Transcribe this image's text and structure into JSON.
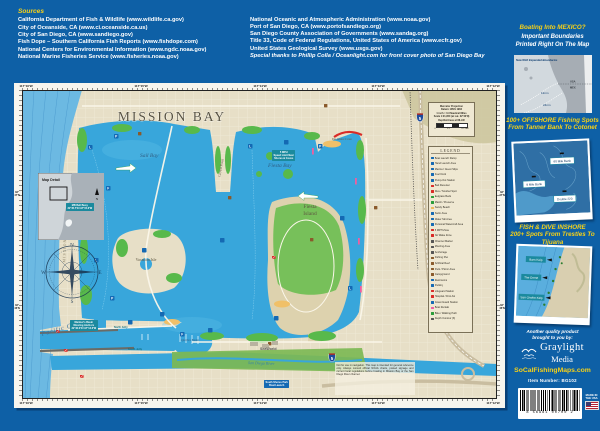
{
  "colors": {
    "background": "#0e60a6",
    "accent_yellow": "#f7d117",
    "ocean": "#6cb9e2",
    "bay": "#38a6db",
    "land": "#e7dfc7",
    "eelgrass": "#58b94b",
    "legend_paper": "#efe8d2",
    "callout_teal": "#1b8a9e",
    "marker_blue": "#1469b3",
    "dive_red": "#d92b27"
  },
  "sources": {
    "heading": "Sources",
    "left": [
      "California Department of Fish & Wildlife (www.wildlife.ca.gov)",
      "City of Oceanside, CA (www.ci.oceanside.ca.us)",
      "City of San Diego, CA (www.sandiego.gov)",
      "Fish Dope – Southern California Fish Reports (www.fishdope.com)",
      "National Centers for Environmental Information (www.ngdc.noaa.gov)",
      "National Marine Fisheries Service (www.fisheries.noaa.gov)"
    ],
    "right": [
      "National Oceanic and Atmospheric Administration (www.noaa.gov)",
      "Port of San Diego, CA (www.portofsandiego.org)",
      "San Diego County Association of Governments (www.sandag.org)",
      "Title 33, Code of Federal Regulations, United States of America (www.ecfr.gov)",
      "United States Geological Survey (www.usgs.gov)",
      "Special thanks to Phillip Colla / Oceanlight.com for front cover photo of San Diego Bay"
    ]
  },
  "sidebar": {
    "mexico": {
      "title": "Boating Into MEXICO?",
      "subtitle1": "Important Boundaries",
      "subtitle2": "Printed Right On The Map",
      "note": "Now With Expanded Boundaries",
      "nm12": "12nm",
      "nm24": "24nm",
      "usa": "USA",
      "mex": "MEX"
    },
    "offshore": {
      "title": "100+ OFFSHORE Fishing Spots",
      "subtitle": "From Tanner Bank To Cotonet",
      "spots": [
        "9 Mile Bank",
        "60 Mile Bank",
        "Double 220"
      ]
    },
    "inshore": {
      "title": "FISH & DIVE INSHORE",
      "subtitle": "200+ Spots From Trestles To Tijuana",
      "spots": [
        "Barn Kelp",
        "The Dome",
        "San Onofre Kelp"
      ]
    },
    "brand": {
      "tagline1": "Another quality product",
      "tagline2": "brought to you by:",
      "name_top": "Graylight",
      "name_bottom": "Media",
      "website": "SoCalFishingMaps.com",
      "item_number": "Item Number:  BG102",
      "made_in": "MADE IN THE USA",
      "barcode_digits": "8 56981 00700 2"
    }
  },
  "map": {
    "title": "MISSION BAY",
    "labels": {
      "sail_bay": "Sail Bay",
      "fiesta_bay": "Fiesta Bay",
      "fiesta_island_1": "Fiesta",
      "fiesta_island_2": "Island",
      "vacation_isle": "Vacation Isle",
      "crown_point": "Crown Point",
      "de_anza": "De Anza Cove",
      "mission_beach": "MISSION BEACH",
      "pacific_ocean": "Pacific Ocean",
      "quivira": "Quivira Basin",
      "river": "San Diego River",
      "seaworld": "SeaWorld",
      "i5": "5"
    },
    "grid": {
      "top": [
        "117°16'W",
        "117°15'W",
        "117°14'W",
        "117°13'W",
        "117°12'W"
      ],
      "bottom": [
        "117°16'W",
        "117°15'W",
        "117°14'W",
        "117°13'W",
        "117°12'W"
      ],
      "lat": [
        {
          "deg": "32°",
          "min": "47'N"
        },
        {
          "deg": "32°",
          "min": "46'N"
        }
      ]
    },
    "legend": {
      "title": "LEGEND",
      "items": [
        {
          "c": "#1469b3",
          "t": "Boat Launch Ramp"
        },
        {
          "c": "#1469b3",
          "t": "Hand Launch Area"
        },
        {
          "c": "#1469b3",
          "t": "Marina / Guest Slips"
        },
        {
          "c": "#1469b3",
          "t": "Fuel Dock"
        },
        {
          "c": "#1469b3",
          "t": "Pump-Out Station"
        },
        {
          "c": "#d92b27",
          "t": "Bait Receiver"
        },
        {
          "c": "#d92b27",
          "t": "Dive / Snorkel Spot"
        },
        {
          "c": "#2a9d3a",
          "t": "Eelgrass Beds"
        },
        {
          "c": "#2a9d3a",
          "t": "Marsh / Preserve"
        },
        {
          "c": "#f0b95a",
          "t": "Sandy Beach"
        },
        {
          "c": "#1469b3",
          "t": "Swim Area"
        },
        {
          "c": "#1469b3",
          "t": "Water Ski Area"
        },
        {
          "c": "#1469b3",
          "t": "Personal Watercraft Area"
        },
        {
          "c": "#d92b27",
          "t": "5 MPH Zone"
        },
        {
          "c": "#d92b27",
          "t": "No Wake Zone"
        },
        {
          "c": "#555555",
          "t": "Channel Marker"
        },
        {
          "c": "#555555",
          "t": "Mooring Area"
        },
        {
          "c": "#555555",
          "t": "Anchorage"
        },
        {
          "c": "#8a5a2b",
          "t": "Fishing Pier"
        },
        {
          "c": "#8a5a2b",
          "t": "Artificial Reef"
        },
        {
          "c": "#8a5a2b",
          "t": "Park / Picnic Area"
        },
        {
          "c": "#8a5a2b",
          "t": "Campground"
        },
        {
          "c": "#1469b3",
          "t": "Restrooms"
        },
        {
          "c": "#1469b3",
          "t": "Parking"
        },
        {
          "c": "#d92b27",
          "t": "Lifeguard Station"
        },
        {
          "c": "#d92b27",
          "t": "Hospital / First Aid"
        },
        {
          "c": "#1469b3",
          "t": "Coast Guard Station"
        },
        {
          "c": "#ee5fa0",
          "t": "Boat Rentals"
        },
        {
          "c": "#2a9d3a",
          "t": "Bike / Walking Path"
        },
        {
          "c": "#555555",
          "t": "Depth Contour (ft)"
        }
      ]
    },
    "projection": {
      "lines": [
        "Mercator Projection",
        "Datum: WGS 1984",
        "1 inch = 0.3 Nautical Miles",
        "Scale 1:21,950 (at Lat. 32°46'N)",
        "Depths/Areas at MLLW"
      ],
      "scale": [
        "0",
        "0.1",
        "0.2 NM"
      ]
    },
    "inset": {
      "title": "Map Detail",
      "north": "N"
    },
    "compass": {
      "n": "N",
      "e": "E",
      "s": "S",
      "w": "W"
    },
    "callouts": {
      "buoy": [
        "MB Bell Buoy",
        "32°45.7'N  117°15.6'W"
      ],
      "mariners": [
        "Mariner's Basin",
        "Mooring Anchors",
        "32°46.0'N  117°14.6'W"
      ],
      "speed": [
        "5 MPH",
        "Speed Limit Near",
        "Shores & Coves"
      ],
      "south_shores": [
        "South Shores Park",
        "Boat Launch"
      ],
      "north_jetty": "North Jetty",
      "south_jetty": "South Jetty"
    },
    "disclaimer": "Not for use in navigation. This map is intended for general reference only. Always consult official NOAA charts, posted signage and current local regulations before boating in Mission Bay or the San Diego River channel."
  }
}
